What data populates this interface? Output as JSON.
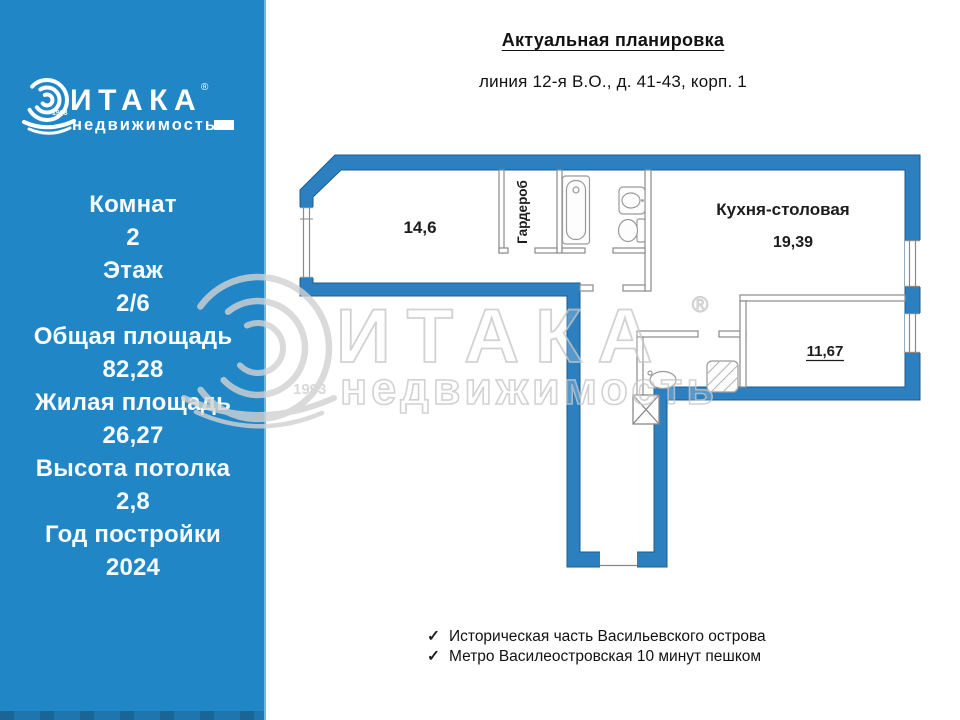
{
  "colors": {
    "sidebar_blue": "#2186c5",
    "wall_blue": "#2c80c0",
    "wall_edge": "#1a5d8e",
    "thin_wall_gray": "#8a8a8a",
    "watermark_gray": "#cfcfcf",
    "text_dark": "#121212"
  },
  "sidebar": {
    "logo": {
      "brand": "ИТАКА",
      "reg": "®",
      "sub": "недвижимость",
      "year": "1993"
    },
    "stats": [
      {
        "label": "Комнат",
        "value": "2"
      },
      {
        "label": "Этаж",
        "value": "2/6"
      },
      {
        "label": "Общая площадь",
        "value": "82,28"
      },
      {
        "label": "Жилая площадь",
        "value": "26,27"
      },
      {
        "label": "Высота потолка",
        "value": "2,8"
      },
      {
        "label": "Год постройки",
        "value": "2024"
      }
    ]
  },
  "header": {
    "title": "Актуальная планировка",
    "address": "линия 12-я В.О., д. 41-43, корп. 1"
  },
  "plan": {
    "rooms": {
      "living_area": "14,6",
      "wardrobe": "Гардероб",
      "kitchen": "Кухня-столовая",
      "kitchen_area": "19,39",
      "bedroom_area": "11,67"
    }
  },
  "watermark": {
    "brand": "ИТАКА",
    "reg": "®",
    "sub": "недвижимость",
    "year": "1993"
  },
  "footer": {
    "check": "✓",
    "features": [
      "Историческая часть Васильевского острова",
      "Метро Василеостровская 10 минут пешком"
    ]
  }
}
